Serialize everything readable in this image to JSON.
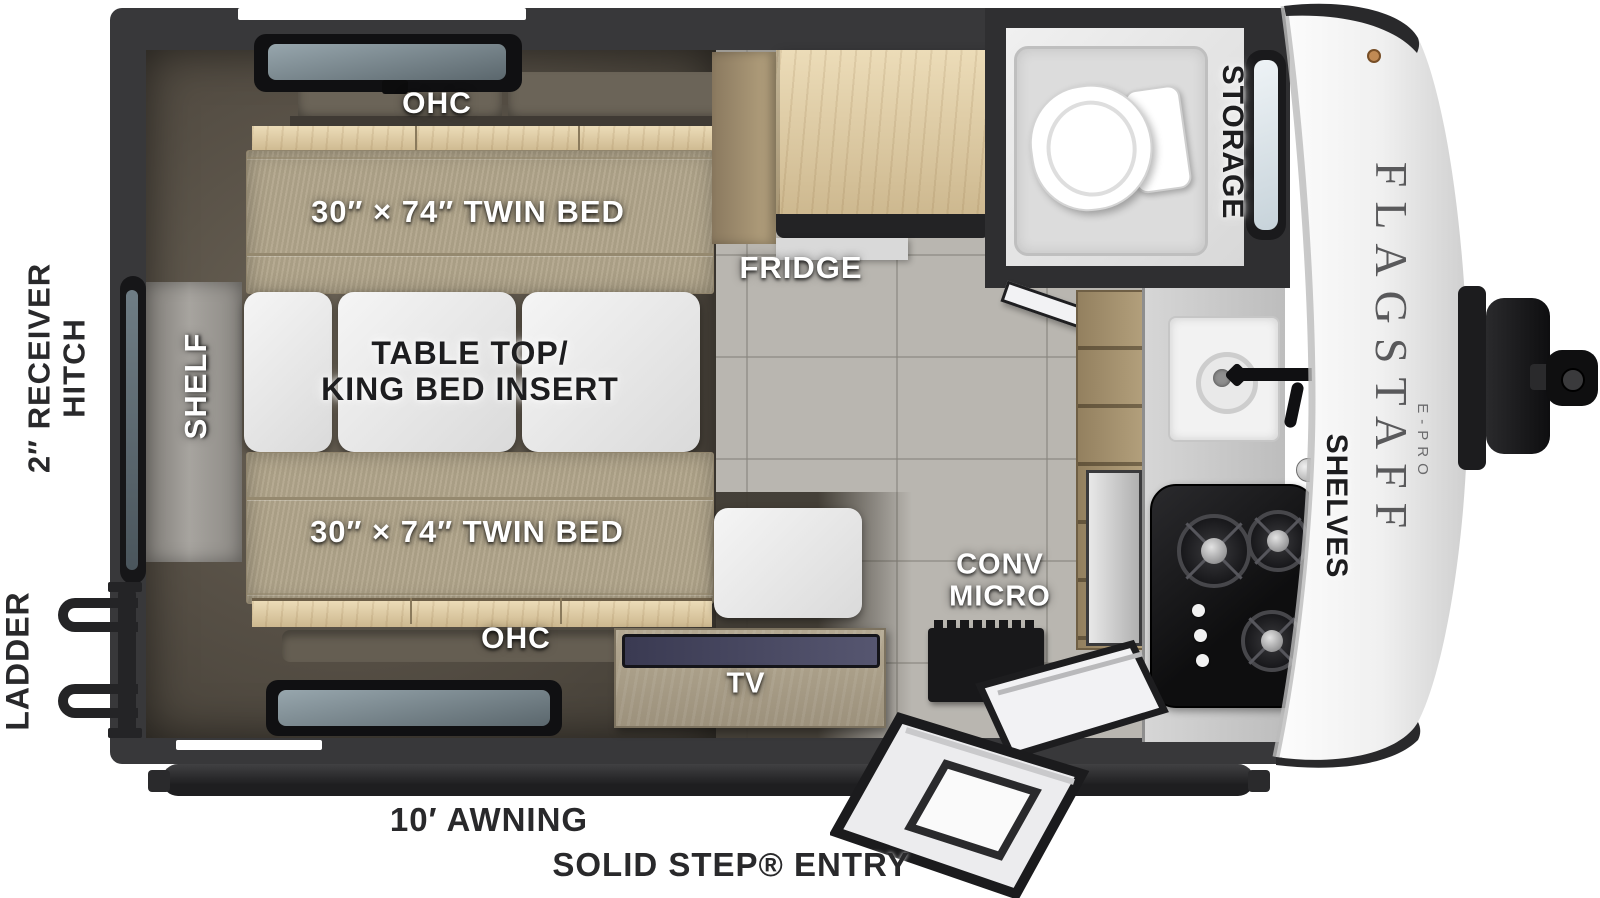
{
  "brand": {
    "name": "FLAGSTAFF",
    "model": "E-PRO"
  },
  "exterior_labels": {
    "receiver_hitch_line1": "2″ RECEIVER",
    "receiver_hitch_line2": "HITCH",
    "ladder": "LADDER",
    "awning": "10′ AWNING",
    "entry": "SOLID STEP® ENTRY"
  },
  "interior_labels": {
    "ohc_top": "OHC",
    "twin_bed_top": "30″ × 74″ TWIN BED",
    "shelf": "SHELF",
    "table_top_line1": "TABLE TOP/",
    "table_top_line2": "KING BED INSERT",
    "twin_bed_bottom": "30″ × 74″ TWIN BED",
    "ohc_bottom": "OHC",
    "tv": "TV",
    "fridge": "FRIDGE",
    "storage": "STORAGE",
    "conv_micro_line1": "CONV",
    "conv_micro_line2": "MICRO",
    "shelves": "SHELVES"
  },
  "colors": {
    "wall": "#38383a",
    "floor_tile": "#b9b6b0",
    "bedroom_floor": "#564f45",
    "mattress": "#b2a68c",
    "wood_light": "#ddcaa5",
    "counter": "#cccccc",
    "cooktop": "#141416",
    "cap_white": "#f5f5f5",
    "label_white": "#ffffff",
    "label_dark": "#1d1d1f"
  }
}
